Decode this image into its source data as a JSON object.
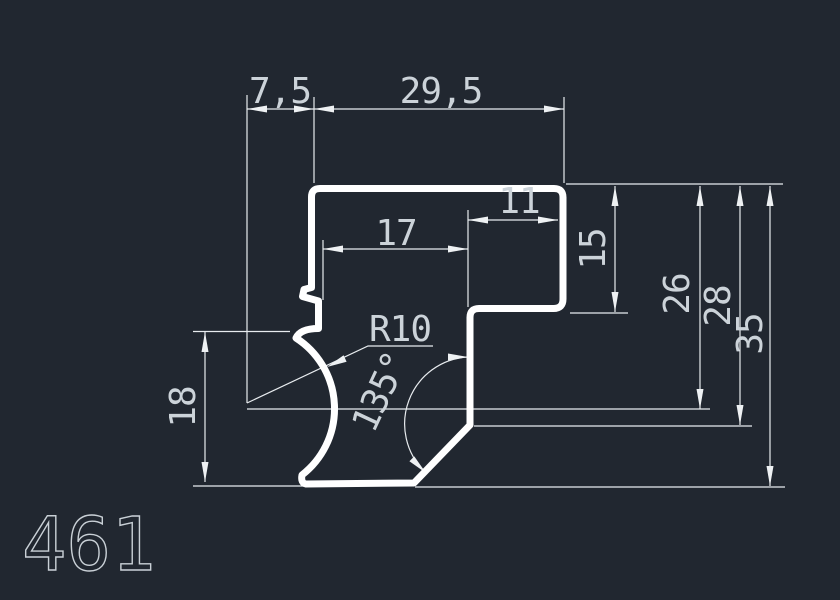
{
  "drawing": {
    "type": "cad-profile-cross-section",
    "profile_number": "461",
    "labels": {
      "dim_7_5": "7,5",
      "dim_29_5": "29,5",
      "dim_17": "17",
      "dim_11": "11",
      "dim_15": "15",
      "dim_26": "26",
      "dim_28": "28",
      "dim_35": "35",
      "dim_18": "18",
      "radius": "R10",
      "angle": "135°"
    },
    "colors": {
      "background": "#212730",
      "profile_outline": "#ffffff",
      "dimension_lines": "#e8ecef",
      "dimension_text": "#ccd3d9"
    }
  }
}
